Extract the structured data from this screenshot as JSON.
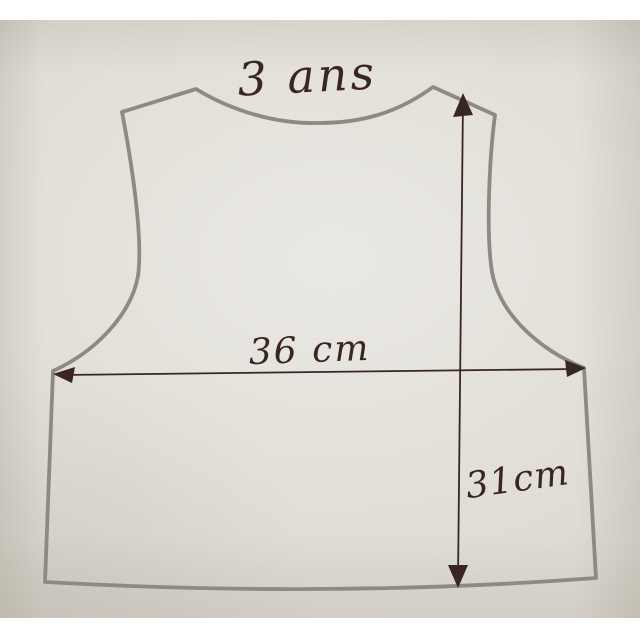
{
  "meta": {
    "description": "Photograph of a hand-drawn child's vest sewing pattern on cream paper, outlined in grey marker with measurement arrows in dark ink"
  },
  "pattern": {
    "size_label": "3 ans",
    "width_label": "36 cm",
    "height_label": "31cm",
    "measurements": {
      "width_cm": 36,
      "height_cm": 31,
      "size": "3 ans"
    }
  },
  "colors": {
    "paper": "#dedbd3",
    "outline_marker": "#8d8a84",
    "ink": "#3a2522",
    "frame": "#ffffff"
  }
}
